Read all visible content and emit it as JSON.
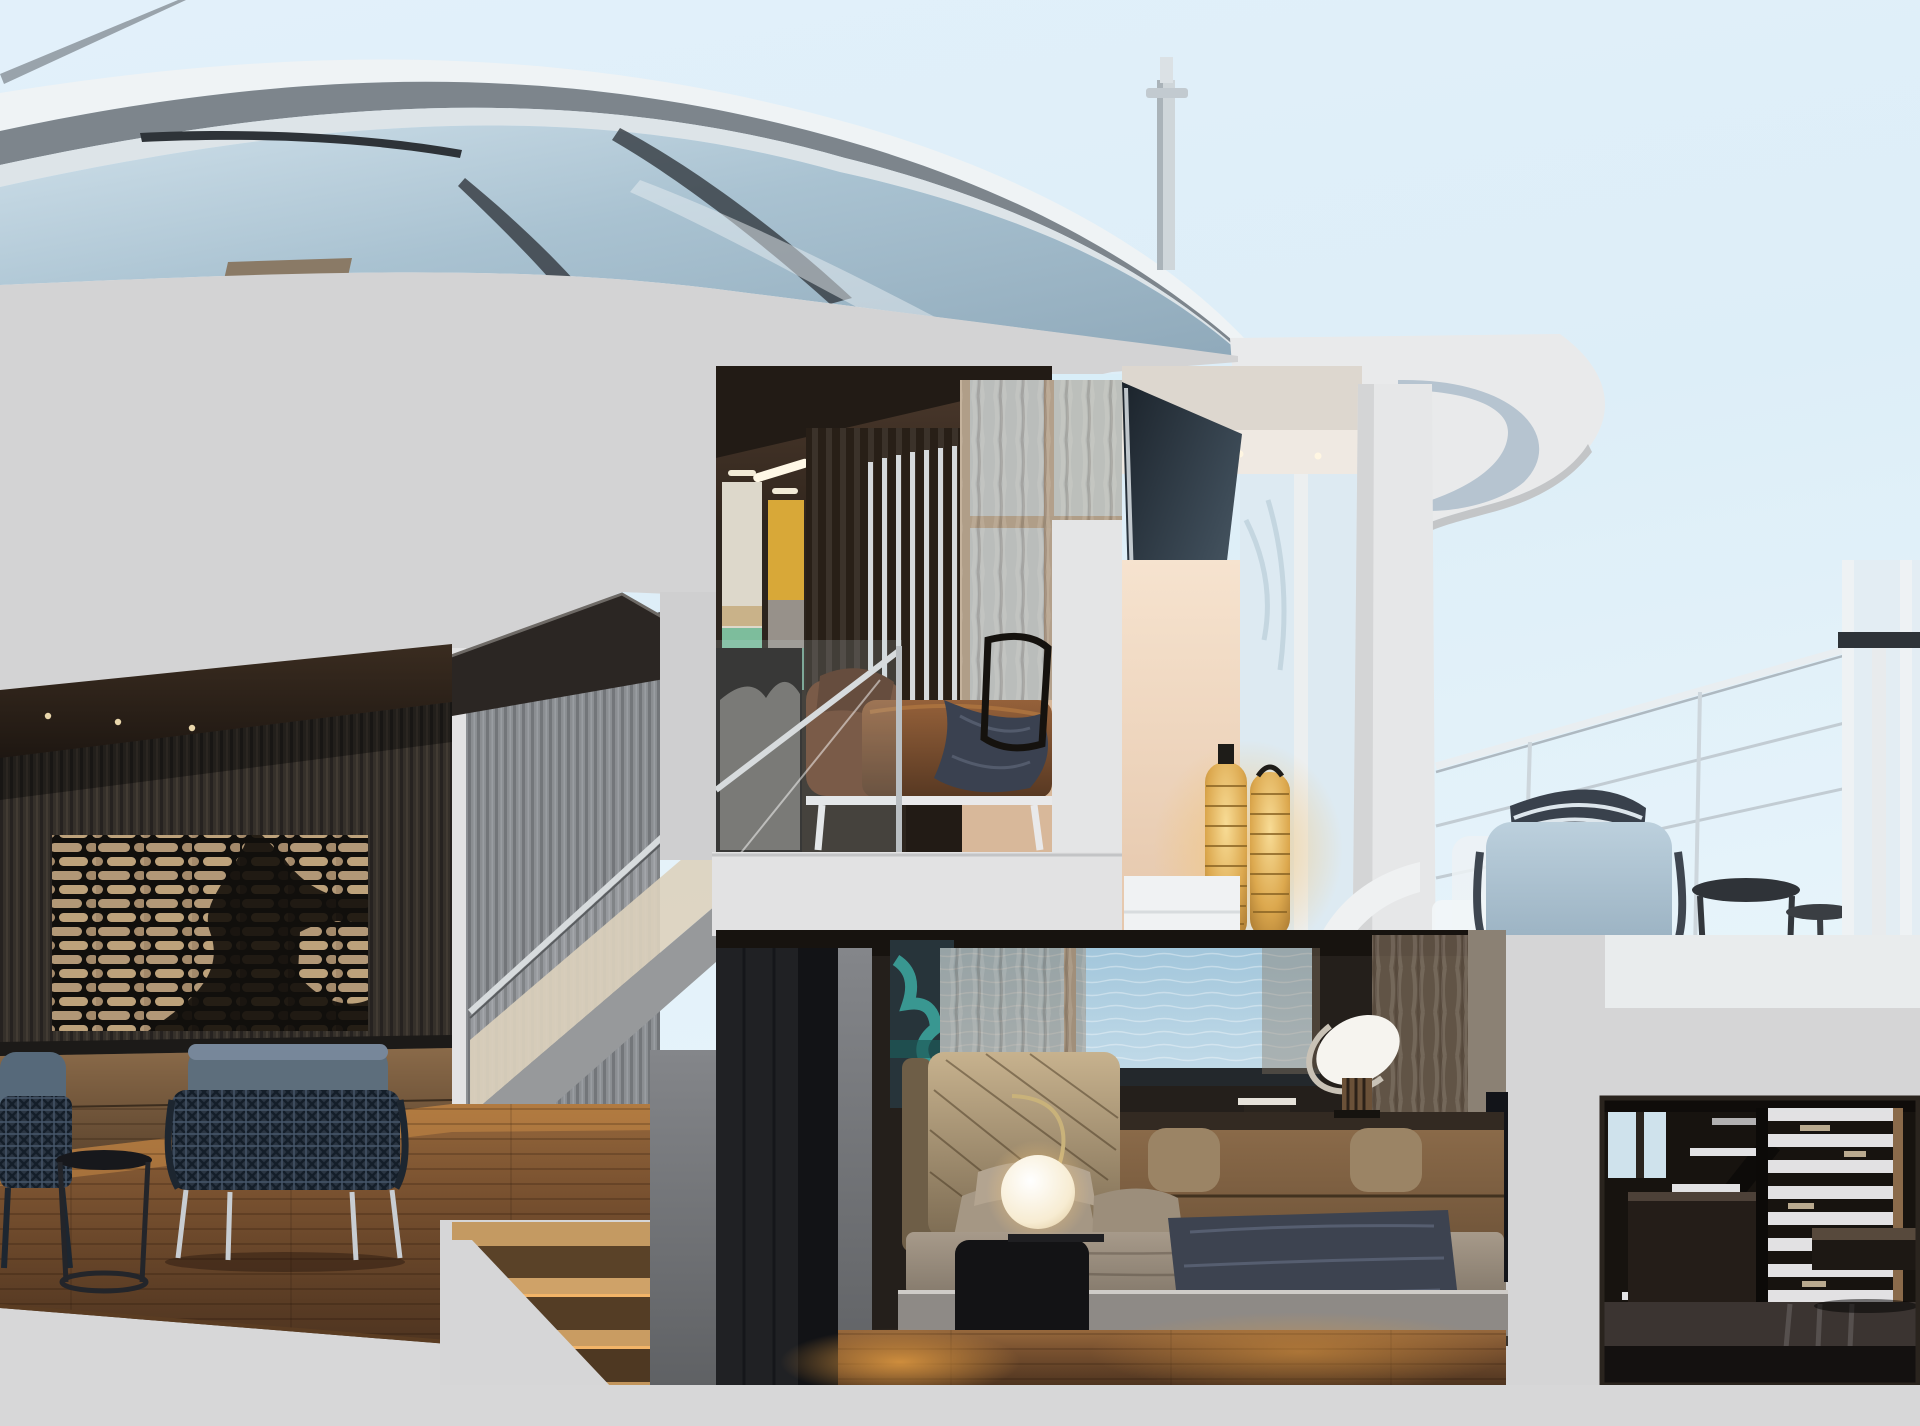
{
  "meta": {
    "kind": "photorealistic 3d cutaway rendering",
    "subject": "luxury yacht cross-section showing two interior decks and aft deck",
    "no_visible_text": true
  },
  "palette": {
    "sky": "#e6f3fa",
    "cut_gray": "#d3d3d4",
    "slab_white": "#e2e2e3",
    "deck_floor": "#e9eced",
    "fascia_gray": "#d5d5d6",
    "bottom_gray": "#d7d7d8",
    "sea": "#aecde0",
    "wood_warm": "#7a5232",
    "salon_wall_dark": "#35302a",
    "ceiling_brown": "#30251c",
    "leather_brown": "#7c4e2c",
    "lantern_gold": "#d8a84e",
    "peach_wall": "#eed6bd",
    "navy_throw": "#3c4350",
    "deck_chair_blue": "#a9bfcf",
    "glass_blue": "#b4cad9",
    "cream_wall": "#d9cdb6"
  },
  "scene": {
    "exterior": {
      "superstructure": "curved glass and silver bands of yacht bow superstructure",
      "mast": "antenna mast on top deck",
      "railing": "aft deck cable railing",
      "sky": "pale clear sky",
      "sea": "calm water seen through cabin window"
    },
    "rooms": [
      {
        "name": "main-salon",
        "objects": [
          "whale-tail brick artwork",
          "slatted dark wall",
          "leather credenza",
          "two woven lounge chairs",
          "wire side table",
          "warm lit wood floor"
        ]
      },
      {
        "name": "stair-hall",
        "objects": [
          "gray slatted wall",
          "glass balustrade with steel handrail",
          "dark roof wedge",
          "lit wooden steps"
        ]
      },
      {
        "name": "upper-lounge",
        "objects": [
          "dark ceiling with linear lights",
          "green abstract art panel",
          "yellow abstract art panel",
          "backlit slat screen",
          "sheer curtains",
          "brown leather daybed",
          "navy throw",
          "glass balustrade"
        ]
      },
      {
        "name": "aft-deck",
        "objects": [
          "white overhang with curled soffit",
          "tilted dark glass panel",
          "two golden lantern lamps",
          "pale blue armchair with striped pillow",
          "round side tables",
          "spiral stair hint",
          "cable railing"
        ]
      },
      {
        "name": "master-cabin",
        "objects": [
          "sea view window",
          "sheer curtains",
          "teal abstract art",
          "tufted headboard bed",
          "navy throw blanket",
          "black cylinder nightstand",
          "globe table lamp",
          "wood console desk",
          "tilted dish lamp",
          "wire sculpture",
          "tv panel",
          "stools",
          "warm wood floor"
        ]
      },
      {
        "name": "lower-stair-room",
        "objects": [
          "white horizontal slat screen",
          "floating dark stairs",
          "dark vanity",
          "glossy dark floor",
          "floating bench"
        ]
      }
    ]
  }
}
